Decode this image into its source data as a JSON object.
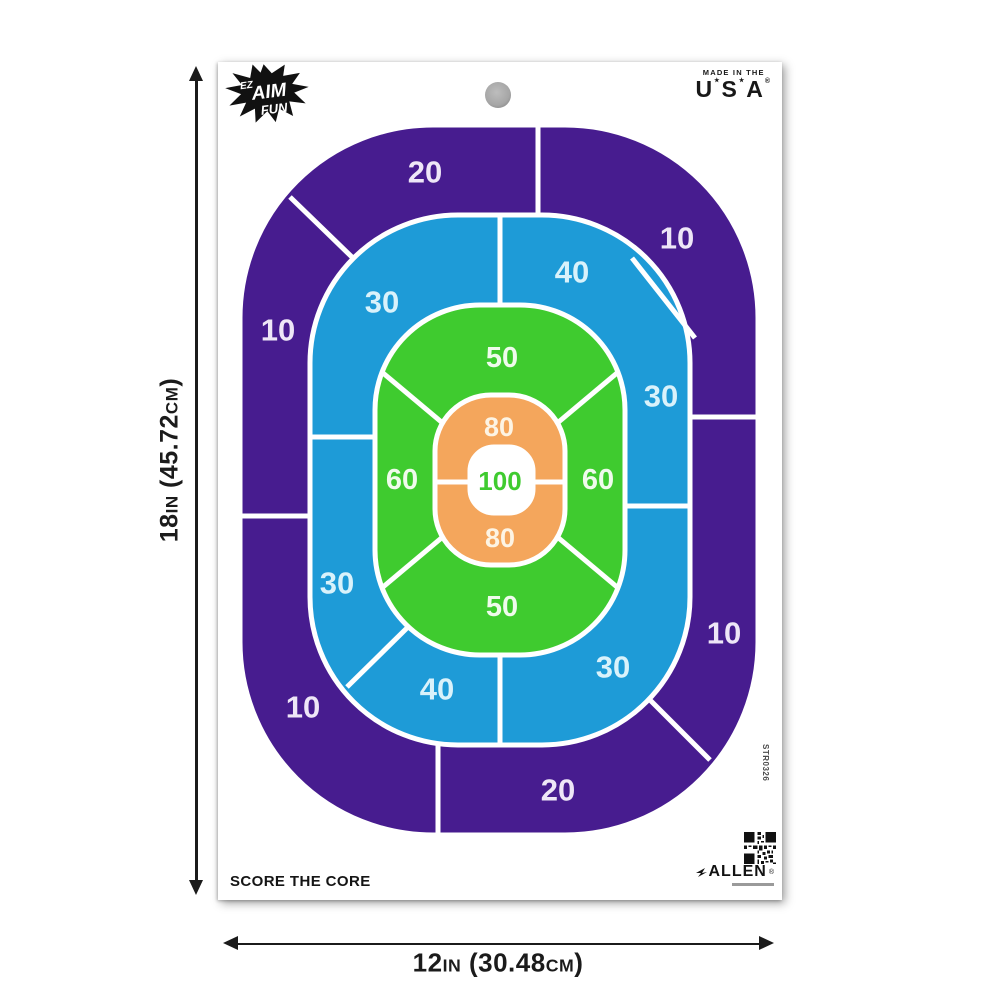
{
  "branding": {
    "logo": {
      "ez": "EZ",
      "aim": "AIM",
      "fun": "FUN"
    },
    "made_in": {
      "line1": "MADE IN THE",
      "u": "U",
      "s": "S",
      "a": "A",
      "star": "★",
      "reg": "®"
    },
    "tagline": "SCORE THE CORE",
    "sku": "STR0326",
    "allen": {
      "name": "ALLEN",
      "reg": "®"
    }
  },
  "dimensions": {
    "height": {
      "text": "18IN (45.72CM)",
      "p1": "18",
      "p2": "IN",
      "p3": " (45.72",
      "p4": "CM",
      "p5": ")"
    },
    "width": {
      "text": "12IN (30.48CM)",
      "p1": "12",
      "p2": "IN",
      "p3": " (30.48",
      "p4": "CM",
      "p5": ")"
    }
  },
  "colors": {
    "purple": "#471C8F",
    "blue": "#1E9BD7",
    "green": "#3FCB2F",
    "orange": "#F4A65C",
    "divider": "#FFFFFF",
    "center_text": "#3FCB2F"
  },
  "scores": {
    "purple": [
      "20",
      "10",
      "10",
      "20",
      "10",
      "10"
    ],
    "blue": [
      "30",
      "40",
      "30",
      "30",
      "40",
      "30"
    ],
    "green": [
      "50",
      "60",
      "60",
      "50"
    ],
    "orange": [
      "80",
      "80"
    ],
    "center": "100"
  }
}
